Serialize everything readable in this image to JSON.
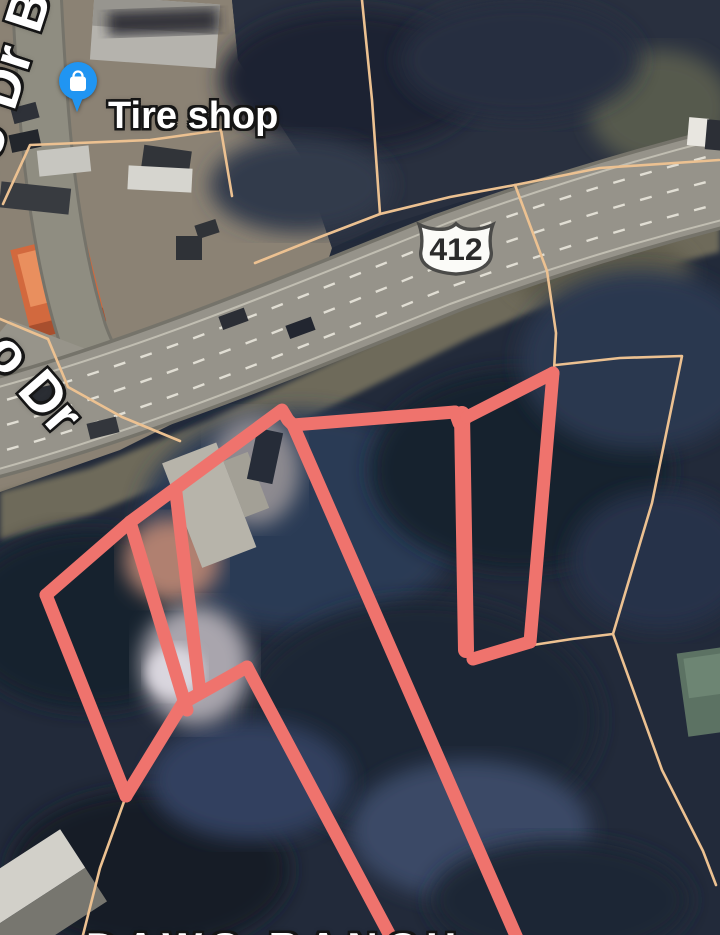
{
  "window": {
    "width": 720,
    "height": 935
  },
  "map": {
    "view_type": "satellite",
    "poi": {
      "label": "Tire shop",
      "icon": "shopping-bag-pin-icon",
      "pin_color": "#2095f2"
    },
    "route_shield": {
      "system": "US Route",
      "number": "412"
    },
    "street_labels": {
      "vertical_topleft": "oo Dr B",
      "curve_left": "o Dr",
      "bottom_clipped_partial": "DAWS RANCH"
    },
    "place_label": {
      "line1": "Hard",
      "line2": "Mus"
    },
    "overlay": {
      "highlight_color": "#ef736d",
      "boundary_color": "#ecc191",
      "red_lines": [
        {
          "points": [
            [
              46,
              595
            ],
            [
              130,
              522
            ],
            [
              282,
              410
            ],
            [
              288,
              420
            ],
            [
              293,
              425
            ],
            [
              455,
              412
            ]
          ]
        },
        {
          "points": [
            [
              46,
              595
            ],
            [
              126,
              796
            ]
          ]
        },
        {
          "points": [
            [
              126,
              796
            ],
            [
              183,
              703
            ],
            [
              247,
              667
            ]
          ]
        },
        {
          "points": [
            [
              247,
              667
            ],
            [
              395,
              945
            ]
          ]
        },
        {
          "points": [
            [
              130,
              522
            ],
            [
              187,
              710
            ]
          ]
        },
        {
          "points": [
            [
              176,
              493
            ],
            [
              200,
              693
            ]
          ]
        },
        {
          "points": [
            [
              293,
              425
            ],
            [
              520,
              945
            ]
          ]
        },
        {
          "points": [
            [
              462,
              414
            ],
            [
              466,
              650
            ]
          ],
          "w": 16
        },
        {
          "points": [
            [
              455,
              412
            ],
            [
              459,
              423
            ],
            [
              467,
              417
            ]
          ]
        },
        {
          "points": [
            [
              467,
              417
            ],
            [
              553,
              373
            ]
          ]
        },
        {
          "points": [
            [
              553,
              373
            ],
            [
              530,
              642
            ]
          ]
        },
        {
          "points": [
            [
              530,
              642
            ],
            [
              473,
              659
            ]
          ]
        }
      ],
      "orange_lines": [
        {
          "points": [
            [
              3,
              204
            ],
            [
              30,
              145
            ],
            [
              150,
              140
            ],
            [
              221,
              130
            ],
            [
              232,
              196
            ]
          ]
        },
        {
          "points": [
            [
              255,
              263
            ],
            [
              320,
              237
            ],
            [
              380,
              214
            ],
            [
              450,
              197
            ],
            [
              515,
              185
            ],
            [
              600,
              168
            ],
            [
              719,
              160
            ]
          ]
        },
        {
          "points": [
            [
              515,
              185
            ],
            [
              547,
              271
            ],
            [
              556,
              333
            ],
            [
              554,
              371
            ]
          ]
        },
        {
          "points": [
            [
              362,
              0
            ],
            [
              372,
              100
            ],
            [
              380,
              214
            ]
          ]
        },
        {
          "points": [
            [
              0,
              319
            ],
            [
              48,
              339
            ],
            [
              68,
              387
            ],
            [
              122,
              417
            ],
            [
              180,
              441
            ]
          ]
        },
        {
          "points": [
            [
              126,
              796
            ],
            [
              100,
              868
            ],
            [
              83,
              935
            ]
          ]
        },
        {
          "points": [
            [
              556,
              365
            ],
            [
              620,
              358
            ],
            [
              682,
              356
            ],
            [
              652,
              503
            ],
            [
              613,
              634
            ],
            [
              662,
              770
            ],
            [
              703,
              851
            ],
            [
              716,
              885
            ]
          ]
        },
        {
          "points": [
            [
              533,
              645
            ],
            [
              572,
              639
            ],
            [
              613,
              634
            ]
          ]
        }
      ]
    }
  }
}
